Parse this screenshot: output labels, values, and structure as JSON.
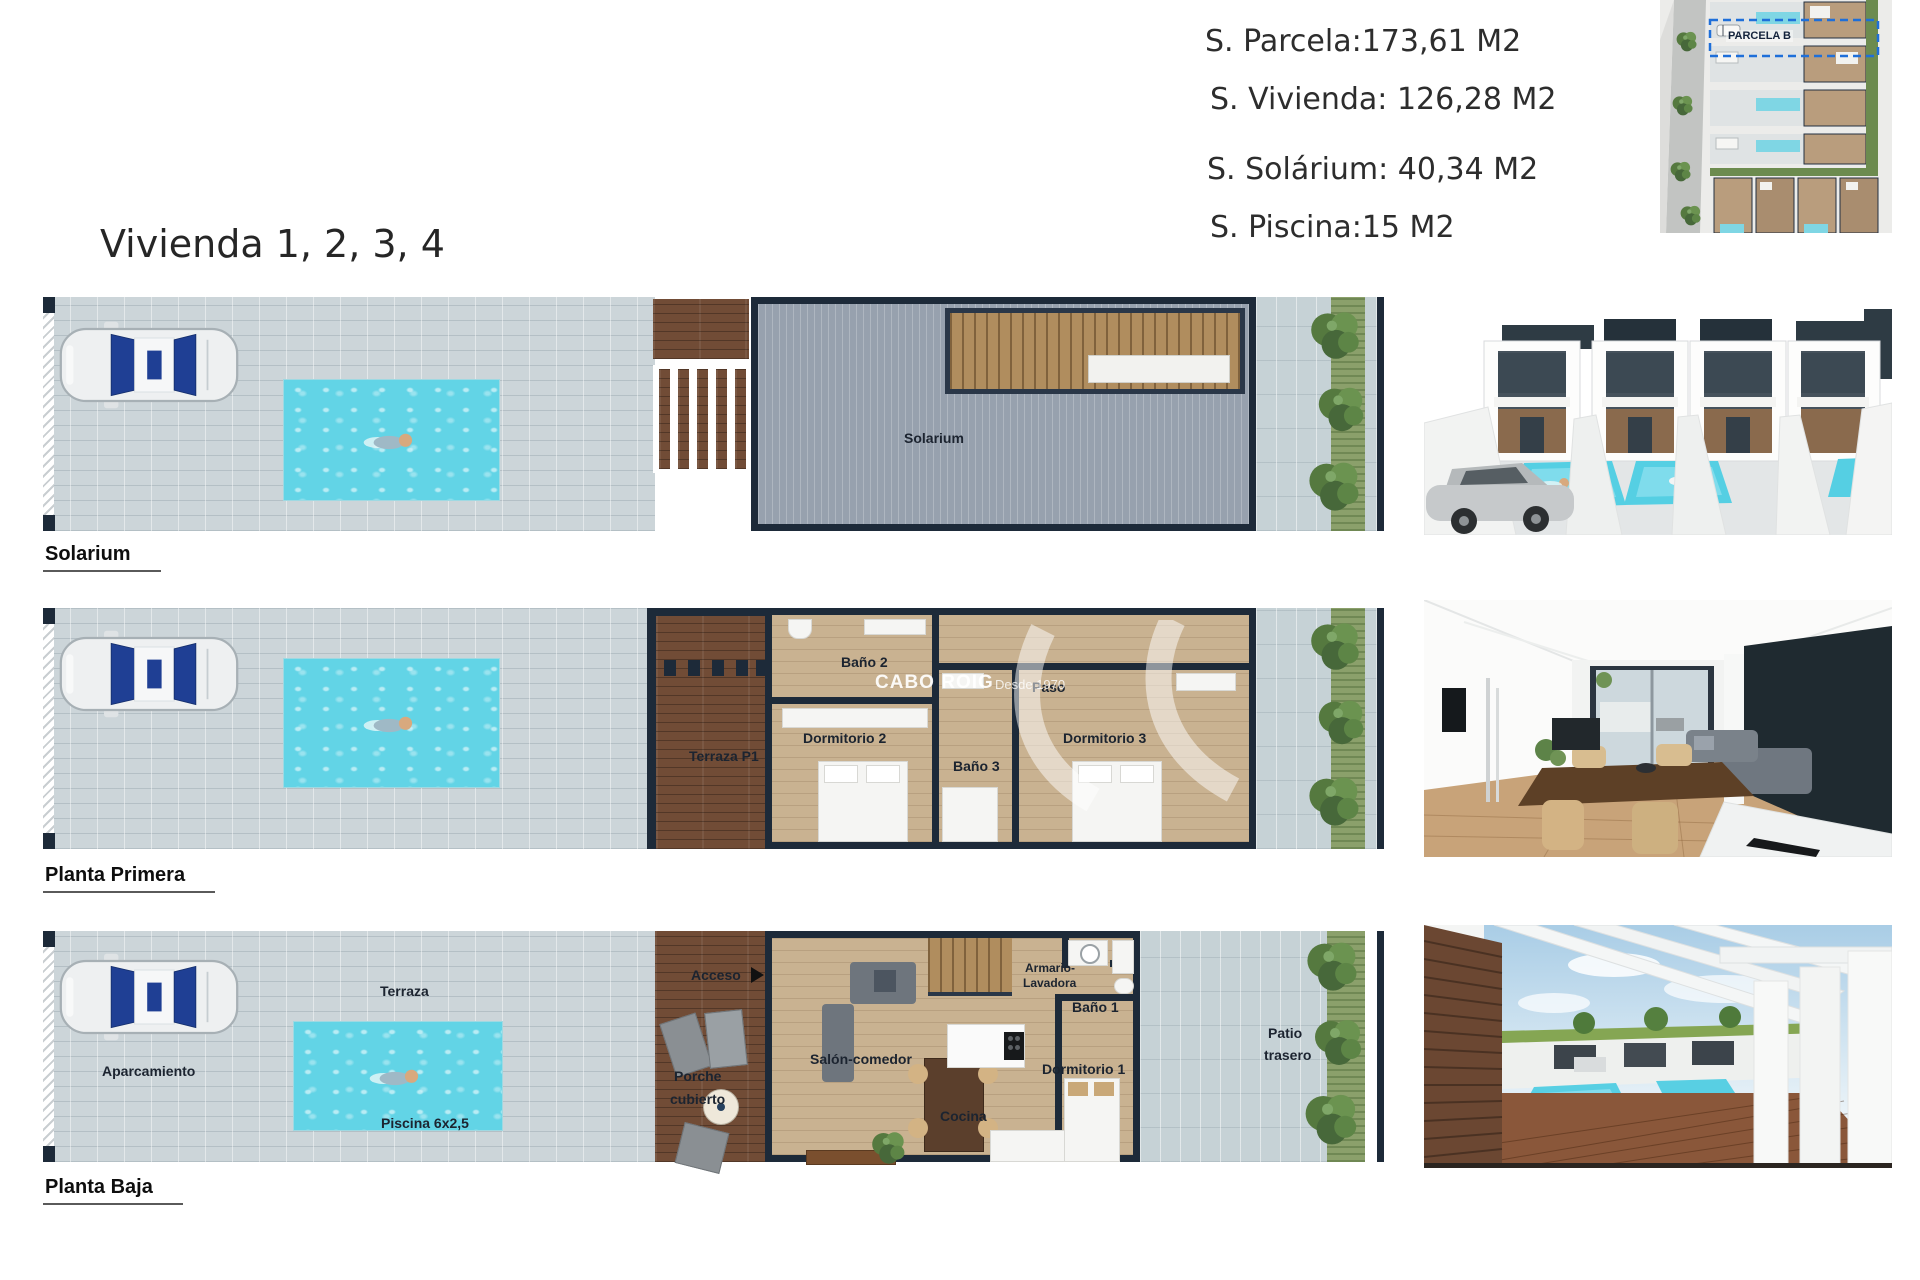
{
  "title": "Vivienda 1, 2, 3, 4",
  "areas": {
    "parcela": "S. Parcela:173,61 M2",
    "vivienda": "S. Vivienda: 126,28 M2",
    "solarium": "S. Solárium: 40,34 M2",
    "piscina": "S. Piscina:15 M2"
  },
  "site_plan": {
    "parcel_label": "PARCELA B"
  },
  "watermark": {
    "brand": "CABO ROIG",
    "since": "Desde 1970"
  },
  "floors": {
    "solarium": {
      "caption": "Solarium",
      "rooms": {
        "solarium": "Solarium"
      }
    },
    "planta_primera": {
      "caption": "Planta Primera",
      "rooms": {
        "terraza_p1": "Terraza P1",
        "bano_2": "Baño 2",
        "dormitorio_2": "Dormitorio 2",
        "bano_3": "Baño 3",
        "paso": "Paso",
        "dormitorio_3": "Dormitorio 3"
      }
    },
    "planta_baja": {
      "caption": "Planta Baja",
      "rooms": {
        "aparcamiento": "Aparcamiento",
        "terraza": "Terraza",
        "piscina": "Piscina 6x2,5",
        "acceso": "Acceso",
        "porche_l1": "Porche",
        "porche_l2": "cubierto",
        "salon_comedor": "Salón-comedor",
        "cocina": "Cocina",
        "armario_l1": "Armario-",
        "armario_l2": "Lavadora",
        "bano_1": "Baño 1",
        "dormitorio_1": "Dormitorio 1",
        "patio_l1": "Patio",
        "patio_l2": "trasero"
      }
    }
  },
  "colors": {
    "wall_navy": "#1d2a39",
    "pool_cyan": "#62d4e6",
    "wood_deck": "#714c36",
    "interior_floor": "#c9b291",
    "paving": "#ccd5d9",
    "solarium_deck": "#97a1ae",
    "parcel_dash_blue": "#1e6fd9",
    "hedge_green": "#55793f"
  }
}
